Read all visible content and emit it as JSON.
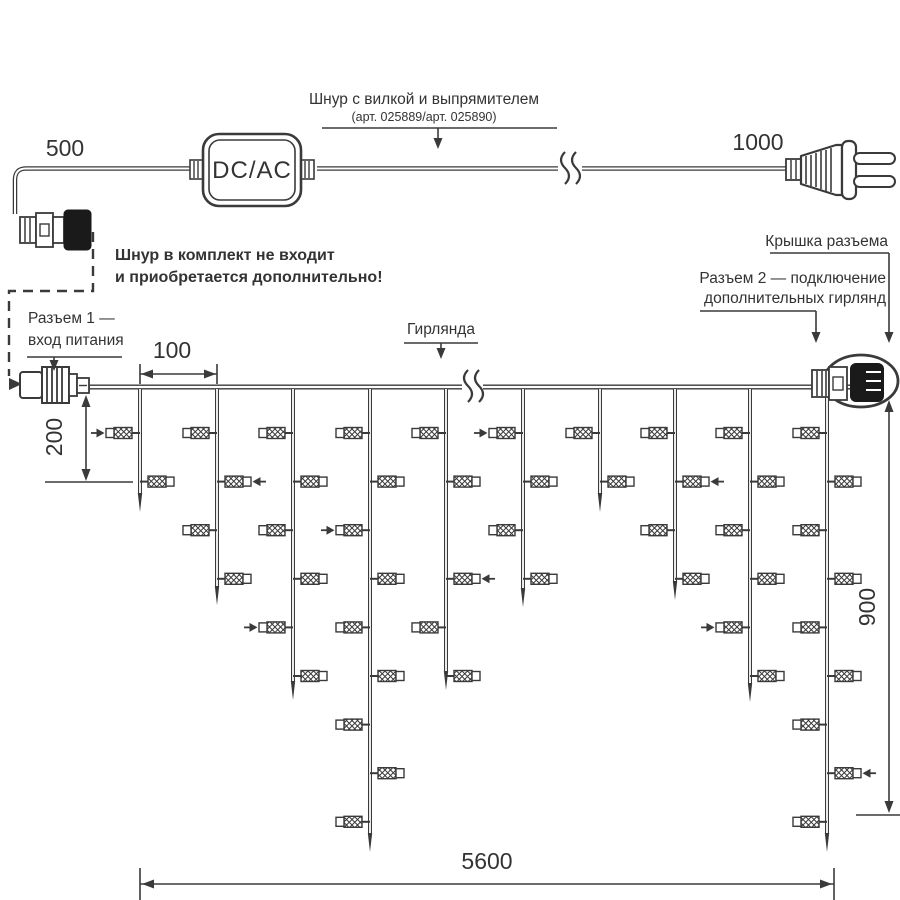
{
  "diagram": {
    "title_labels": {
      "cord_title": "Шнур с вилкой и выпрямителем",
      "cord_articles": "(арт. 025889/арт. 025890)",
      "cord_note_line1": "Шнур в комплект не входит",
      "cord_note_line2": "и приобретается дополнительно!",
      "converter": "DC/AC",
      "connector1_line1": "Разъем 1 —",
      "connector1_line2": "вход питания",
      "garland": "Гирлянда",
      "cap_label": "Крышка разъема",
      "connector2_line1": "Разъем 2 — подключение",
      "connector2_line2": "дополнительных гирлянд"
    },
    "dimensions": {
      "cord_left": "500",
      "cord_right": "1000",
      "drop_spacing": "100",
      "first_drop": "200",
      "max_drop": "900",
      "total_length": "5600"
    },
    "colors": {
      "line": "#3a3a3a",
      "black_part": "#1a1a1a",
      "text": "#333333"
    },
    "garland": {
      "wire_y": 387,
      "wire_x1": 89,
      "wire_x2": 851,
      "break_x": 472,
      "lamp_row_start": 433,
      "lamp_row_step": 48.6,
      "line_color": "#3a3a3a",
      "drops": [
        {
          "x": 140,
          "tip": 512,
          "rows": [
            1,
            2
          ],
          "arrows": {
            "1": "right"
          }
        },
        {
          "x": 217,
          "tip": 605,
          "rows": [
            1,
            2,
            3,
            4
          ],
          "arrows": {
            "2": "left"
          }
        },
        {
          "x": 293,
          "tip": 700,
          "rows": [
            1,
            2,
            3,
            4,
            5,
            6
          ],
          "arrows": {
            "5": "right"
          }
        },
        {
          "x": 370,
          "tip": 852,
          "rows": [
            1,
            2,
            3,
            4,
            5,
            6,
            7,
            8,
            9
          ],
          "arrows": {
            "3": "right"
          }
        },
        {
          "x": 446,
          "tip": 690,
          "rows": [
            1,
            2,
            4,
            5,
            6
          ],
          "arrows": {
            "4": "left"
          }
        },
        {
          "x": 523,
          "tip": 607,
          "rows": [
            1,
            2,
            3,
            4
          ],
          "arrows": {
            "1": "right"
          }
        },
        {
          "x": 600,
          "tip": 512,
          "rows": [
            1,
            2
          ],
          "arrows": {}
        },
        {
          "x": 675,
          "tip": 600,
          "rows": [
            1,
            2,
            3,
            4
          ],
          "arrows": {
            "2": "left"
          }
        },
        {
          "x": 750,
          "tip": 702,
          "rows": [
            1,
            2,
            3,
            4,
            5,
            6
          ],
          "arrows": {
            "5": "right"
          }
        },
        {
          "x": 827,
          "tip": 852,
          "rows": [
            1,
            2,
            3,
            4,
            5,
            6,
            7,
            8,
            9
          ],
          "arrows": {
            "8": "left"
          }
        }
      ]
    }
  }
}
